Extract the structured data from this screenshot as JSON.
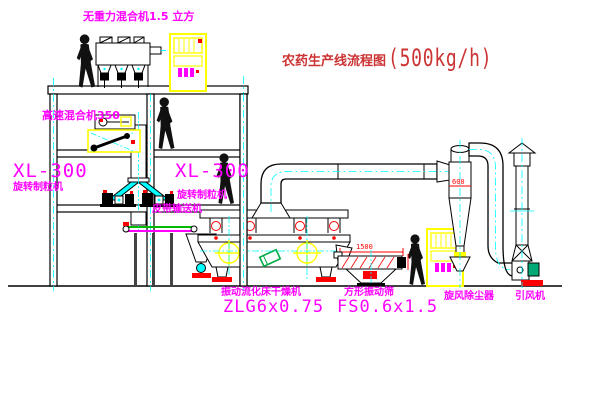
{
  "title": {
    "main": "农药生产线流程图",
    "capacity": "(500kg/h)"
  },
  "equipment_labels": {
    "gravity_mixer": "无重力混合机1.5 立方",
    "high_speed_mixer": "高速混合机350",
    "granulator_left": {
      "model": "XL-300",
      "name": "旋转制粒机"
    },
    "granulator_right": {
      "model": "XL-300",
      "name": "旋转制粒机"
    },
    "belt_conveyor": "皮带输送机",
    "fluid_bed_dryer": {
      "name": "振动流化床干燥机",
      "model": "ZLG6x0.75"
    },
    "vibrating_screen": {
      "name": "方形振动筛",
      "model": "FS0.6x1.5"
    },
    "cyclone": "旋风除尘器",
    "induced_draft_fan": "引风机"
  },
  "dimensions": {
    "cyclone_inlet": "600",
    "screen_length": "1500"
  },
  "colors": {
    "label_magenta": "#ff00ff",
    "title_red": "#cc3333",
    "line_black": "#000000",
    "centerline_cyan": "#00ffff",
    "equipment_yellow": "#ffff00",
    "detail_red": "#ff0000",
    "motor_green": "#00aa77"
  }
}
